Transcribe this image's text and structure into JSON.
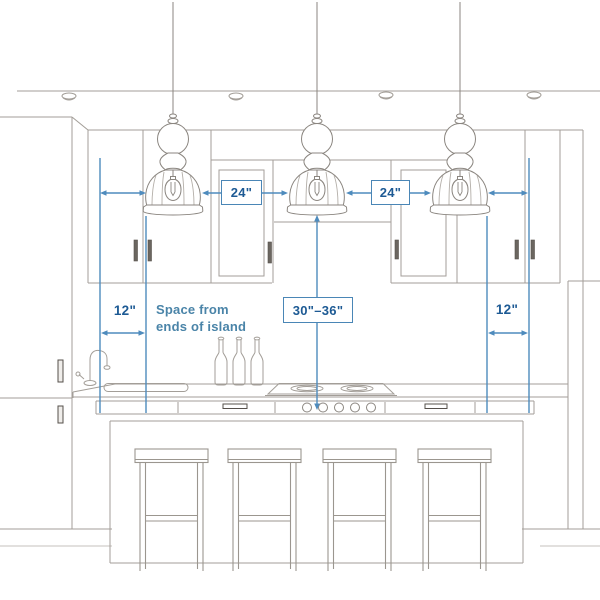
{
  "diagram": {
    "type": "kitchen-island-pendant-spacing-guide",
    "labels": {
      "pendant_gap_left": "24\"",
      "pendant_gap_right": "24\"",
      "island_end_left": "12\"",
      "island_end_right": "12\"",
      "pendant_height": "30\"–36\"",
      "note_line1": "Space from",
      "note_line2": "ends of island"
    },
    "colors": {
      "dimension_line": "#4e8bbd",
      "dimension_text": "#1d5a94",
      "note_text": "#4a84a8",
      "sketch_line": "#a39e98",
      "background": "#ffffff"
    }
  }
}
